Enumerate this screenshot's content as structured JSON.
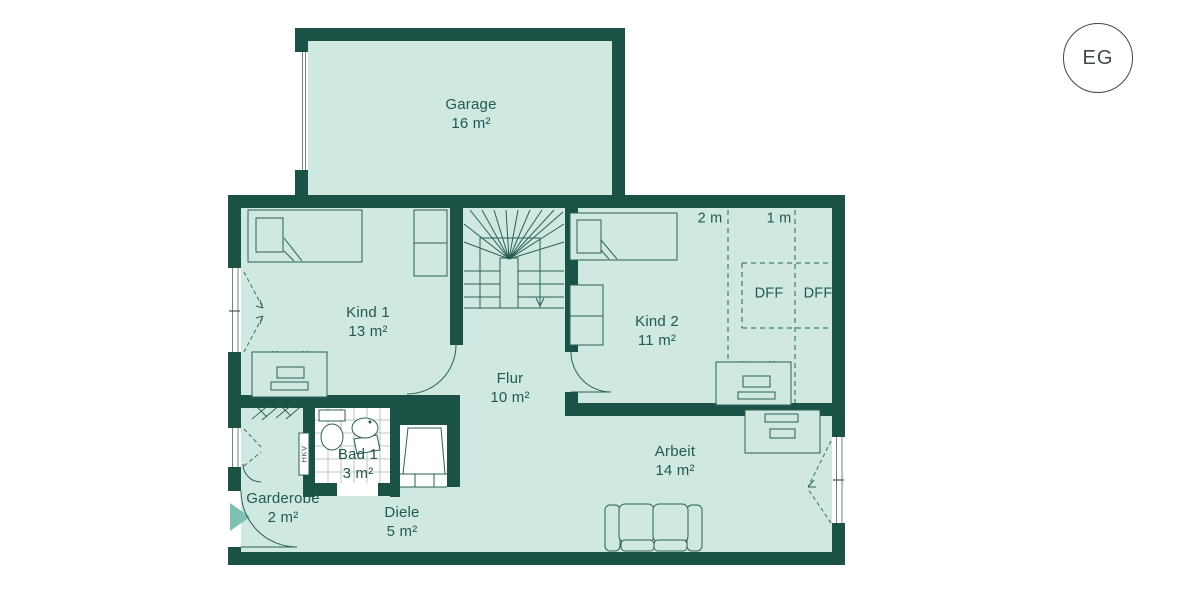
{
  "floor_label": "EG",
  "colors": {
    "wall": "#1a5346",
    "floor": "#cfe8e1",
    "text": "#215a4e",
    "line": "#2a6054",
    "arrow": "#7ec0b1",
    "badge": "#3d4a45"
  },
  "rooms": [
    {
      "name": "Garage",
      "area": "16 m²"
    },
    {
      "name": "Kind 1",
      "area": "13 m²"
    },
    {
      "name": "Kind 2",
      "area": "11 m²"
    },
    {
      "name": "Flur",
      "area": "10 m²"
    },
    {
      "name": "Bad 1",
      "area": "3 m²"
    },
    {
      "name": "Garderobe",
      "area": "2 m²"
    },
    {
      "name": "Diele",
      "area": "5 m²"
    },
    {
      "name": "Arbeit",
      "area": "14 m²"
    }
  ],
  "annotations": {
    "knee_wall_2m": "2 m",
    "knee_wall_1m": "1 m",
    "roof_window_left": "DFF",
    "roof_window_right": "DFF",
    "heating_distributor": "HKV"
  }
}
